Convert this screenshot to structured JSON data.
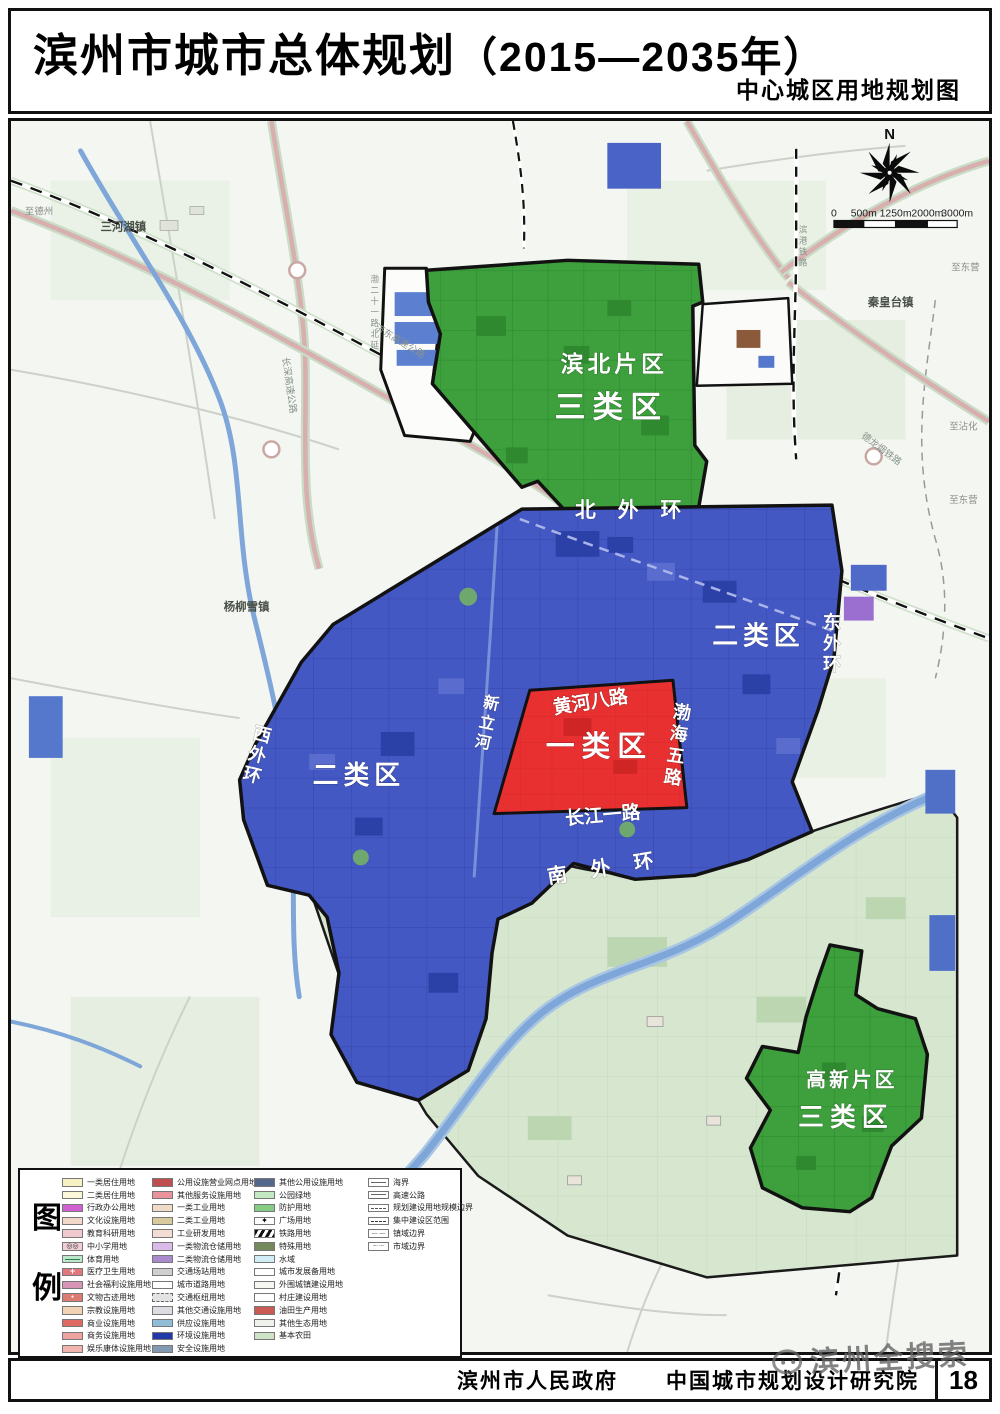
{
  "header": {
    "title": "滨州市城市总体规划",
    "years": "（2015—2035年）",
    "subtitle": "中心城区用地规划图"
  },
  "colors": {
    "class1": "#e83030",
    "class2": "#4458c4",
    "class3": "#3da03d",
    "water": "#7fa6d8",
    "farmland": "#d6e6cf"
  },
  "map": {
    "compass": "N",
    "scale_ticks": [
      "0",
      "500m",
      "1250m",
      "2000m",
      "3000m"
    ],
    "labels": {
      "binbei_district": "滨北片区",
      "binbei_class": "三类区",
      "gaoxin_district": "高新片区",
      "gaoxin_class": "三类区",
      "class1": "一类区",
      "class2_east": "二类区",
      "class2_west": "二类区",
      "ring_north": "北外环",
      "ring_south": "南外环",
      "huanghe8": "黄河八路",
      "changjiang1": "长江一路",
      "town_sanhehu": "三河湖镇",
      "town_yangliuxue": "杨柳雪镇",
      "town_qinhuangtai": "秦皇台镇",
      "dir_dezhou": "至德州",
      "dir_dongying_a": "至东营",
      "dir_zhanhua": "至沾化",
      "dir_dongying_b": "至东营",
      "rail_delongyan": "德龙烟铁路",
      "hwy_jidong": "济东高速公路",
      "hwy_changshen": "长深高速公路"
    },
    "vlabels": {
      "ring_east": [
        "东",
        "外",
        "环"
      ],
      "ring_west": [
        "西",
        "外",
        "环"
      ],
      "bohai5": [
        "渤",
        "海",
        "五",
        "路"
      ],
      "xinli": [
        "新",
        "立",
        "河"
      ],
      "bingang": [
        "滨",
        "港",
        "铁",
        "路"
      ],
      "bo21": [
        "渤",
        "二",
        "十",
        "一",
        "路",
        "北",
        "延"
      ]
    }
  },
  "legend": {
    "title_chars": [
      "图",
      "例"
    ],
    "col1": [
      {
        "label": "一类居住用地",
        "color": "#f6f2c4"
      },
      {
        "label": "二类居住用地",
        "color": "#fbf8da"
      },
      {
        "label": "行政办公用地",
        "color": "#d45fd0"
      },
      {
        "label": "文化设施用地",
        "color": "#f3d7c9"
      },
      {
        "label": "教育科研用地",
        "color": "#f0c9ce"
      },
      {
        "label": "中小学用地",
        "color": "#f2cdd1",
        "style": "circles"
      },
      {
        "label": "体育用地",
        "color": "#bce7c9",
        "style": "line"
      },
      {
        "label": "医疗卫生用地",
        "color": "#e2777d",
        "style": "cross"
      },
      {
        "label": "社会福利设施用地",
        "color": "#d795b5"
      },
      {
        "label": "文物古迹用地",
        "color": "#dd7b72",
        "style": "mark"
      },
      {
        "label": "宗教设施用地",
        "color": "#f1d2b4"
      },
      {
        "label": "商业设施用地",
        "color": "#de6a64"
      },
      {
        "label": "商务设施用地",
        "color": "#eda3a0"
      },
      {
        "label": "娱乐康体设施用地",
        "color": "#f0b3ae"
      }
    ],
    "col2": [
      {
        "label": "公用设施营业网点用地",
        "color": "#bf4e4e"
      },
      {
        "label": "其他服务设施用地",
        "color": "#e9949c"
      },
      {
        "label": "一类工业用地",
        "color": "#eedcc8"
      },
      {
        "label": "二类工业用地",
        "color": "#d9c99f"
      },
      {
        "label": "工业研发用地",
        "color": "#f2dcd3"
      },
      {
        "label": "一类物流仓储用地",
        "color": "#d9bae9"
      },
      {
        "label": "二类物流仓储用地",
        "color": "#a98bcd"
      },
      {
        "label": "交通场站用地",
        "color": "#cfcfcf"
      },
      {
        "label": "城市道路用地",
        "color": "#ffffff"
      },
      {
        "label": "交通枢纽用地",
        "color": "#e3e3e3",
        "style": "dashed"
      },
      {
        "label": "其他交通设施用地",
        "color": "#dcdce2"
      },
      {
        "label": "供应设施用地",
        "color": "#92bdd8"
      },
      {
        "label": "环境设施用地",
        "color": "#2339a8"
      },
      {
        "label": "安全设施用地",
        "color": "#8299b1"
      }
    ],
    "col3": [
      {
        "label": "其他公用设施用地",
        "color": "#53688a"
      },
      {
        "label": "公园绿地",
        "color": "#c2e9c2"
      },
      {
        "label": "防护用地",
        "color": "#86cb86"
      },
      {
        "label": "广场用地",
        "color": "#ffffff",
        "style": "star"
      },
      {
        "label": "铁路用地",
        "style": "hatch"
      },
      {
        "label": "特殊用地",
        "color": "#74895c"
      },
      {
        "label": "水域",
        "color": "#d2edf5"
      },
      {
        "label": "城市发展备用地",
        "color": "#ffffff"
      },
      {
        "label": "外围城镇建设用地",
        "color": "#f7f7f2"
      },
      {
        "label": "村庄建设用地",
        "color": "#ffffff"
      },
      {
        "label": "油田生产用地",
        "color": "#c95b54"
      },
      {
        "label": "其他生态用地",
        "color": "#eef2ea"
      },
      {
        "label": "基本农田",
        "color": "#cfe2c6"
      }
    ],
    "col4": [
      {
        "label": "海界",
        "color": "#ffffff",
        "style": "line-solid"
      },
      {
        "label": "高速公路",
        "color": "#ffffff",
        "style": "line-double"
      },
      {
        "label": "规划建设用地规模边界",
        "color": "#ffffff",
        "style": "line-dashdot"
      },
      {
        "label": "集中建设区范围",
        "color": "#ffffff",
        "style": "line-dash"
      },
      {
        "label": "镇域边界",
        "color": "#ffffff",
        "style": "line-longdash"
      },
      {
        "label": "市域边界",
        "color": "#ffffff",
        "style": "line-dashdotdot"
      }
    ]
  },
  "footer": {
    "government": "滨州市人民政府",
    "institute": "中国城市规划设计研究院",
    "page": "18",
    "watermark": "滨州全搜索"
  }
}
